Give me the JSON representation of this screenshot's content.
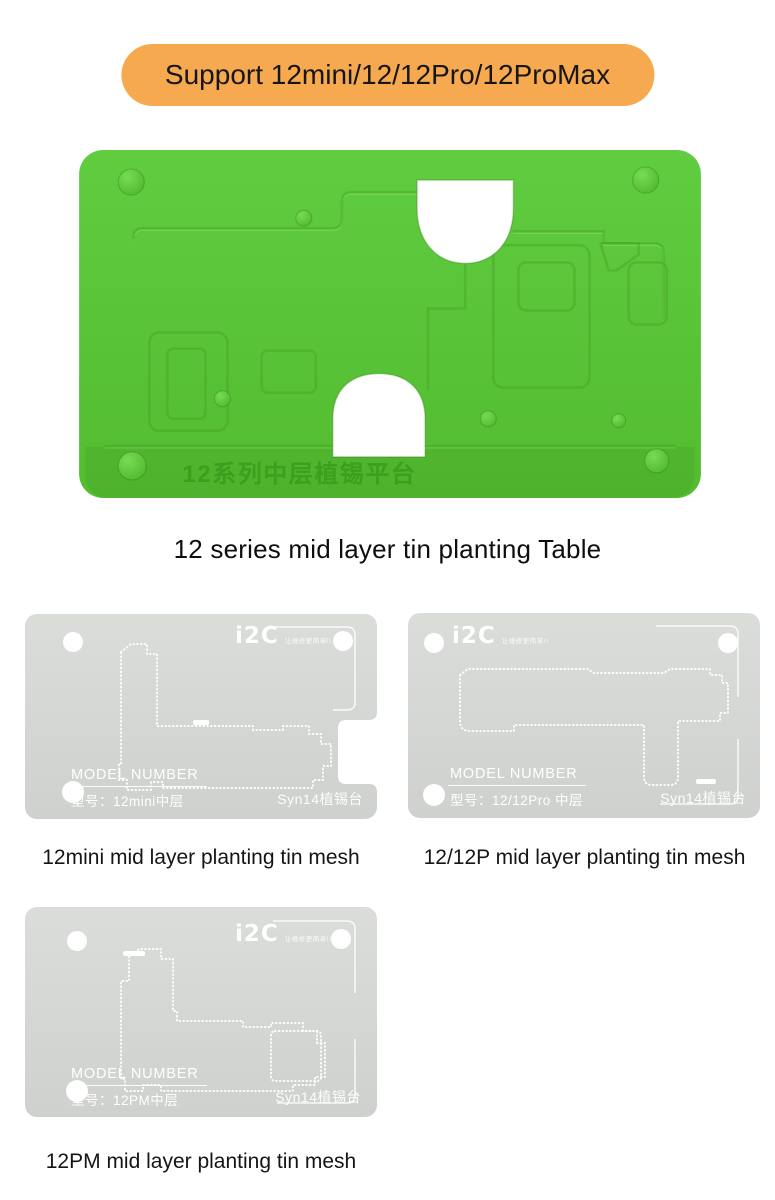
{
  "badge": {
    "label": "Support 12mini/12/12Pro/12ProMax"
  },
  "colors": {
    "badge_bg": "#F6A94E",
    "platform_green": "#5BC636",
    "engraving_green": "#3E9E1D",
    "stencil_gray": "#D7DAD6"
  },
  "platform": {
    "engraving": "12系列中层植锡平台",
    "caption": "12 series mid layer tin planting Table"
  },
  "stencils": [
    {
      "logo": "i2C",
      "slogan": "让维修更简单!!",
      "model_label": "MODEL NUMBER",
      "model_value": "型号：12mini中层",
      "platform_code": "Syn14植锡台",
      "caption": "12mini mid layer planting tin mesh"
    },
    {
      "logo": "i2C",
      "slogan": "让维修更简单!!",
      "model_label": "MODEL NUMBER",
      "model_value": "型号：12/12Pro 中层",
      "platform_code": "Syn14植锡台",
      "caption": "12/12P mid layer planting tin mesh"
    },
    {
      "logo": "i2C",
      "slogan": "让维修更简单!!",
      "model_label": "MODEL NUMBER",
      "model_value": "型号：12PM中层",
      "platform_code": "Syn14植锡台",
      "caption": "12PM mid layer planting tin mesh"
    }
  ]
}
